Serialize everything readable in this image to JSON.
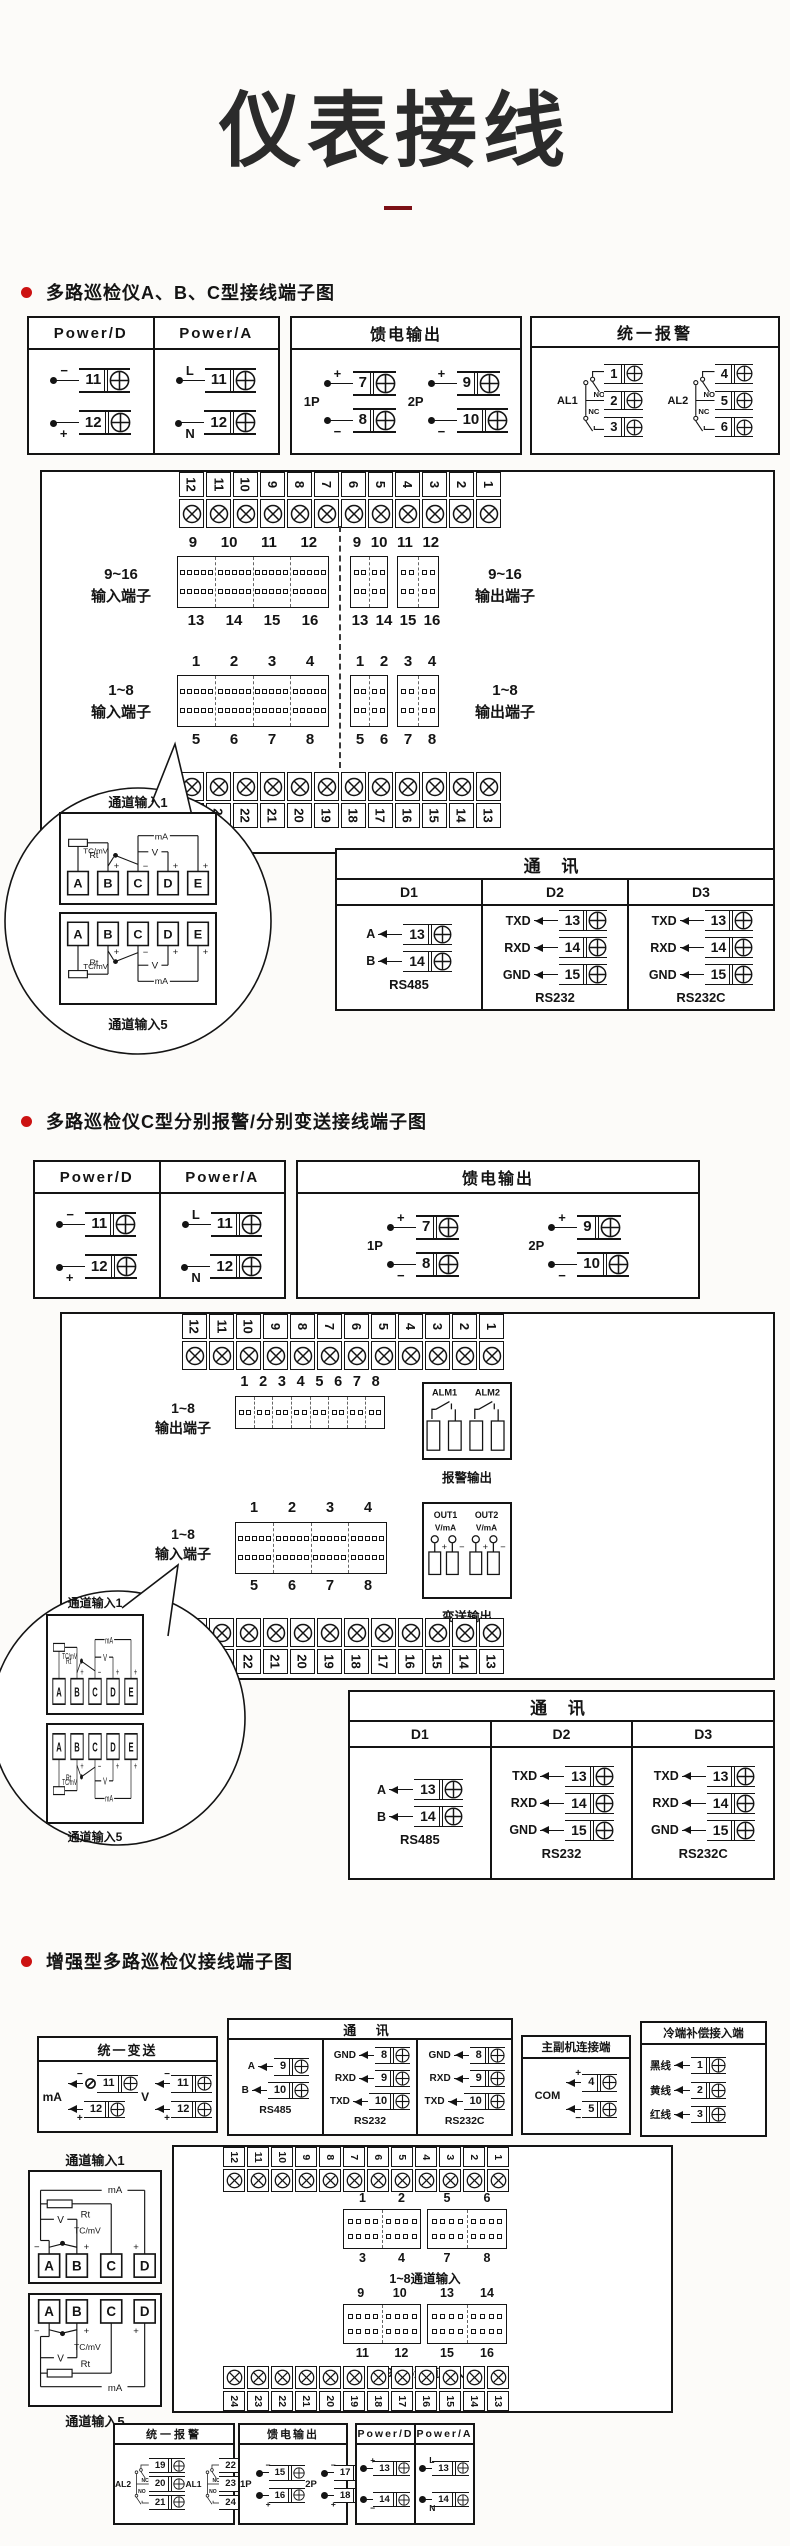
{
  "page": {
    "title": "仪表接线"
  },
  "colors": {
    "accent": "#cc1212",
    "dash": "#7c1016",
    "ink": "#141414"
  },
  "sections": [
    {
      "header": "多路巡检仪A、B、C型接线端子图",
      "power": {
        "cols": [
          {
            "title": "Power/D",
            "terms": [
              {
                "sign": "−",
                "pos": "top",
                "num": "11"
              },
              {
                "sign": "+",
                "pos": "bot",
                "num": "12"
              }
            ]
          },
          {
            "title": "Power/A",
            "terms": [
              {
                "sign": "L",
                "pos": "top",
                "num": "11"
              },
              {
                "sign": "N",
                "pos": "bot",
                "num": "12"
              }
            ]
          }
        ]
      },
      "feed": {
        "title": "馈电输出",
        "groups": [
          {
            "label": "1P",
            "terms": [
              {
                "sign": "+",
                "pos": "top",
                "num": "7"
              },
              {
                "sign": "−",
                "pos": "bot",
                "num": "8"
              }
            ]
          },
          {
            "label": "2P",
            "terms": [
              {
                "sign": "+",
                "pos": "top",
                "num": "9"
              },
              {
                "sign": "−",
                "pos": "bot",
                "num": "10"
              }
            ]
          }
        ]
      },
      "alarm": {
        "title": "统一报警",
        "groups": [
          {
            "label": "AL1",
            "contacts": [
              "NO",
              "NC"
            ],
            "nums": [
              "1",
              "2",
              "3"
            ]
          },
          {
            "label": "AL2",
            "contacts": [
              "NO",
              "NC"
            ],
            "nums": [
              "4",
              "5",
              "6"
            ]
          }
        ]
      },
      "board": {
        "top_strip": [
          "12",
          "11",
          "10",
          "9",
          "8",
          "7",
          "6",
          "5",
          "4",
          "3",
          "2",
          "1"
        ],
        "bottom_strip": [
          "24",
          "23",
          "22",
          "21",
          "20",
          "19",
          "18",
          "17",
          "16",
          "15",
          "14",
          "13"
        ],
        "in916_label": [
          "9~16",
          "输入端子"
        ],
        "in916_top": [
          "9",
          "10",
          "11",
          "12"
        ],
        "in916_bottom": [
          "13",
          "14",
          "15",
          "16"
        ],
        "out916_label": [
          "9~16",
          "输出端子"
        ],
        "out916_top": [
          "9",
          "10",
          "11",
          "12"
        ],
        "out916_bottom": [
          "13",
          "14",
          "15",
          "16"
        ],
        "in18_label": [
          "1~8",
          "输入端子"
        ],
        "in18_top": [
          "1",
          "2",
          "3",
          "4"
        ],
        "in18_bottom": [
          "5",
          "6",
          "7",
          "8"
        ],
        "out18_label": [
          "1~8",
          "输出端子"
        ],
        "out18_top": [
          "1",
          "2",
          "3",
          "4"
        ],
        "out18_bottom": [
          "5",
          "6",
          "7",
          "8"
        ]
      },
      "balloon": {
        "label_top": "通道输入1",
        "label_bottom": "通道输入5",
        "letters": [
          "A",
          "B",
          "C",
          "D",
          "E"
        ],
        "w_labels": {
          "rt": "Rt",
          "tc": "TC/mV",
          "v": "V",
          "ma": "mA",
          "plus": "+",
          "minus": "−"
        }
      },
      "comm": {
        "title": "通  讯",
        "cols": [
          {
            "head": "D1",
            "rows": [
              {
                "ann": "A",
                "num": "13"
              },
              {
                "ann": "B",
                "num": "14"
              }
            ],
            "foot": "RS485"
          },
          {
            "head": "D2",
            "rows": [
              {
                "ann": "TXD",
                "num": "13"
              },
              {
                "ann": "RXD",
                "num": "14"
              },
              {
                "ann": "GND",
                "num": "15"
              }
            ],
            "foot": "RS232"
          },
          {
            "head": "D3",
            "rows": [
              {
                "ann": "TXD",
                "num": "13"
              },
              {
                "ann": "RXD",
                "num": "14"
              },
              {
                "ann": "GND",
                "num": "15"
              }
            ],
            "foot": "RS232C"
          }
        ]
      }
    },
    {
      "header": "多路巡检仪C型分别报警/分别变送接线端子图",
      "power": {
        "cols": [
          {
            "title": "Power/D",
            "terms": [
              {
                "sign": "−",
                "pos": "top",
                "num": "11"
              },
              {
                "sign": "+",
                "pos": "bot",
                "num": "12"
              }
            ]
          },
          {
            "title": "Power/A",
            "terms": [
              {
                "sign": "L",
                "pos": "top",
                "num": "11"
              },
              {
                "sign": "N",
                "pos": "bot",
                "num": "12"
              }
            ]
          }
        ]
      },
      "feed": {
        "title": "馈电输出",
        "groups": [
          {
            "label": "1P",
            "terms": [
              {
                "sign": "+",
                "pos": "top",
                "num": "7"
              },
              {
                "sign": "−",
                "pos": "bot",
                "num": "8"
              }
            ]
          },
          {
            "label": "2P",
            "terms": [
              {
                "sign": "+",
                "pos": "top",
                "num": "9"
              },
              {
                "sign": "−",
                "pos": "bot",
                "num": "10"
              }
            ]
          }
        ]
      },
      "board": {
        "top_strip": [
          "12",
          "11",
          "10",
          "9",
          "8",
          "7",
          "6",
          "5",
          "4",
          "3",
          "2",
          "1"
        ],
        "bottom_strip": [
          "24",
          "23",
          "22",
          "21",
          "20",
          "19",
          "18",
          "17",
          "16",
          "15",
          "14",
          "13"
        ],
        "out18_label": [
          "1~8",
          "输出端子"
        ],
        "out18_nums": [
          "1",
          "2",
          "3",
          "4",
          "5",
          "6",
          "7",
          "8"
        ],
        "in18_label": [
          "1~8",
          "输入端子"
        ],
        "in18_top": [
          "1",
          "2",
          "3",
          "4"
        ],
        "in18_bottom": [
          "5",
          "6",
          "7",
          "8"
        ]
      },
      "alm_box": {
        "labels": [
          "ALM1",
          "ALM2"
        ],
        "caption": "报警输出"
      },
      "out_box": {
        "cols": [
          {
            "name": "OUT1",
            "unit": "V/mA"
          },
          {
            "name": "OUT2",
            "unit": "V/mA"
          }
        ],
        "plus": "+",
        "minus": "−",
        "caption": "变送输出"
      },
      "balloon": {
        "label_top": "通道输入1",
        "label_bottom": "通道输入5",
        "letters": [
          "A",
          "B",
          "C",
          "D",
          "E"
        ],
        "w_labels": {
          "rt": "Rt",
          "tc": "TC/mV",
          "v": "V",
          "ma": "mA",
          "plus": "+",
          "minus": "−"
        }
      },
      "comm": {
        "title": "通  讯",
        "cols": [
          {
            "head": "D1",
            "rows": [
              {
                "ann": "A",
                "num": "13"
              },
              {
                "ann": "B",
                "num": "14"
              }
            ],
            "foot": "RS485"
          },
          {
            "head": "D2",
            "rows": [
              {
                "ann": "TXD",
                "num": "13"
              },
              {
                "ann": "RXD",
                "num": "14"
              },
              {
                "ann": "GND",
                "num": "15"
              }
            ],
            "foot": "RS232"
          },
          {
            "head": "D3",
            "rows": [
              {
                "ann": "TXD",
                "num": "13"
              },
              {
                "ann": "RXD",
                "num": "14"
              },
              {
                "ann": "GND",
                "num": "15"
              }
            ],
            "foot": "RS232C"
          }
        ]
      }
    },
    {
      "header": "增强型多路巡检仪接线端子图",
      "trans": {
        "title": "统一变送",
        "groups": [
          {
            "label": "mA",
            "meter": true,
            "terms": [
              {
                "sign": "−",
                "pos": "top",
                "num": "11"
              },
              {
                "sign": "+",
                "pos": "bot",
                "num": "12"
              }
            ]
          },
          {
            "label": "V",
            "meter": false,
            "terms": [
              {
                "sign": "−",
                "pos": "top",
                "num": "11"
              },
              {
                "sign": "+",
                "pos": "bot",
                "num": "12"
              }
            ]
          }
        ]
      },
      "comm": {
        "title": "通  讯",
        "cols": [
          {
            "rows": [
              {
                "ann": "A",
                "num": "9"
              },
              {
                "ann": "B",
                "num": "10"
              }
            ],
            "foot": "RS485"
          },
          {
            "rows": [
              {
                "ann": "GND",
                "num": "8"
              },
              {
                "ann": "RXD",
                "num": "9"
              },
              {
                "ann": "TXD",
                "num": "10"
              }
            ],
            "foot": "RS232"
          },
          {
            "rows": [
              {
                "ann": "GND",
                "num": "8"
              },
              {
                "ann": "RXD",
                "num": "9"
              },
              {
                "ann": "TXD",
                "num": "10"
              }
            ],
            "foot": "RS232C"
          }
        ]
      },
      "link": {
        "title": "主副机连接端",
        "label": "COM",
        "rows": [
          {
            "sign": "+",
            "pos": "top",
            "num": "4"
          },
          {
            "sign": "−",
            "pos": "bot",
            "num": "5"
          }
        ]
      },
      "cold": {
        "title": "冷端补偿接入端",
        "rows": [
          {
            "ann": "黑线",
            "num": "1"
          },
          {
            "ann": "黄线",
            "num": "2"
          },
          {
            "ann": "红线",
            "num": "3"
          }
        ]
      },
      "chan": {
        "label_top": "通道输入1",
        "label_bottom": "通道输入5",
        "letters": [
          "A",
          "B",
          "C",
          "D"
        ],
        "w_labels": {
          "rt": "Rt",
          "tc": "TC/mV",
          "v": "V",
          "ma": "mA",
          "plus": "+",
          "minus": "−"
        }
      },
      "board": {
        "top_strip": [
          "12",
          "11",
          "10",
          "9",
          "8",
          "7",
          "6",
          "5",
          "4",
          "3",
          "2",
          "1"
        ],
        "bottom_strip": [
          "24",
          "23",
          "22",
          "21",
          "20",
          "19",
          "18",
          "17",
          "16",
          "15",
          "14",
          "13"
        ],
        "grp18": {
          "caption": "1~8通道输入",
          "blocks": [
            {
              "top": [
                "1",
                "2"
              ],
              "bottom": [
                "3",
                "4"
              ]
            },
            {
              "top": [
                "5",
                "6"
              ],
              "bottom": [
                "7",
                "8"
              ]
            }
          ]
        },
        "grp916": {
          "caption": "9~16通道输入",
          "blocks": [
            {
              "top": [
                "9",
                "10"
              ],
              "bottom": [
                "11",
                "12"
              ]
            },
            {
              "top": [
                "13",
                "14"
              ],
              "bottom": [
                "15",
                "16"
              ]
            }
          ]
        }
      },
      "alarm": {
        "title": "统一报警",
        "groups": [
          {
            "label": "AL2",
            "contacts": [
              "NC",
              "NO"
            ],
            "nums": [
              "19",
              "20",
              "21"
            ]
          },
          {
            "label": "AL1",
            "contacts": [
              "NC",
              "NO"
            ],
            "nums": [
              "22",
              "23",
              "24"
            ]
          }
        ]
      },
      "feed": {
        "title": "馈电输出",
        "groups": [
          {
            "label": "1P",
            "terms": [
              {
                "sign": "−",
                "pos": "top",
                "num": "15"
              },
              {
                "sign": "+",
                "pos": "bot",
                "num": "16"
              }
            ]
          },
          {
            "label": "2P",
            "terms": [
              {
                "sign": "−",
                "pos": "top",
                "num": "17"
              },
              {
                "sign": "+",
                "pos": "bot",
                "num": "18"
              }
            ]
          }
        ]
      },
      "power": {
        "cols": [
          {
            "title": "Power/D",
            "terms": [
              {
                "sign": "+",
                "pos": "top",
                "num": "13"
              },
              {
                "sign": "−",
                "pos": "bot",
                "num": "14"
              }
            ]
          },
          {
            "title": "Power/A",
            "terms": [
              {
                "sign": "L",
                "pos": "top",
                "num": "13"
              },
              {
                "sign": "N",
                "pos": "bot",
                "num": "14"
              }
            ]
          }
        ]
      }
    }
  ]
}
